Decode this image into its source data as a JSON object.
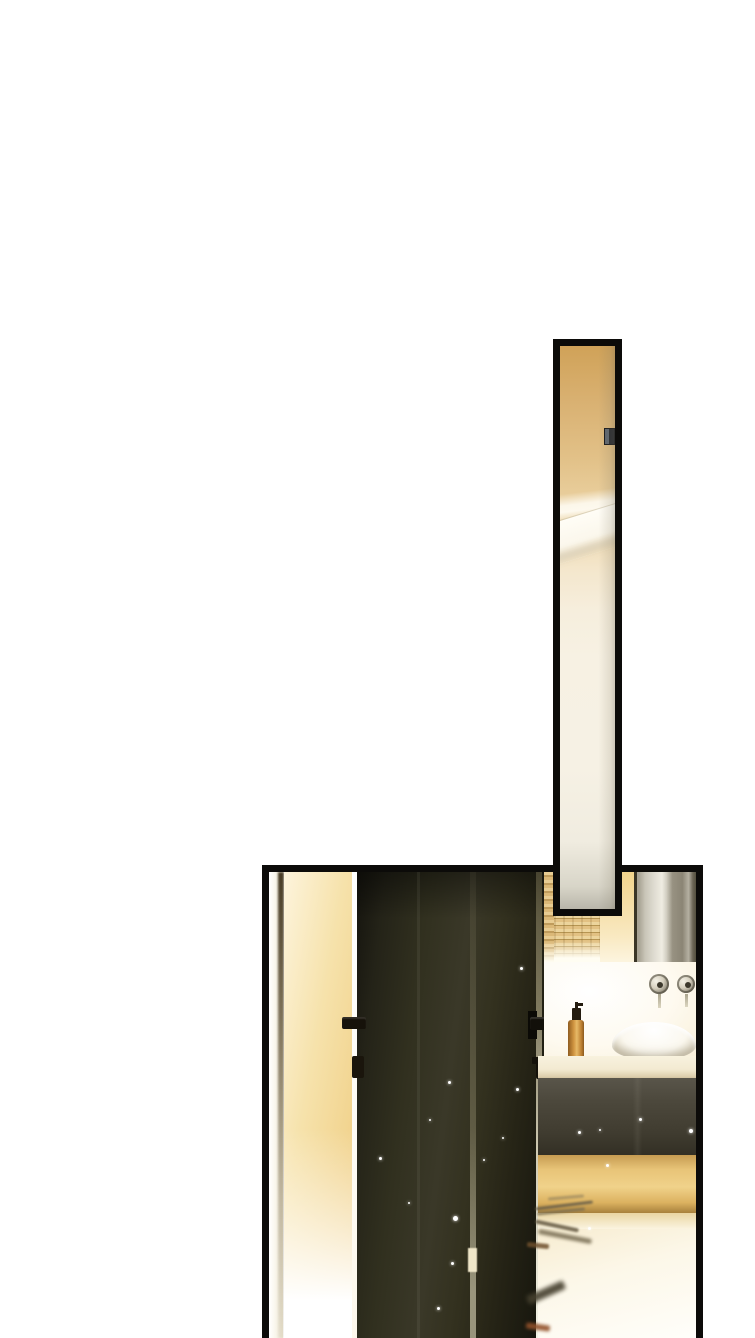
{
  "canvas": {
    "width": 755,
    "height": 1338,
    "background": "#ffffff"
  },
  "artwork": {
    "type": "webtoon-comic-page-fragment",
    "text_content": "none",
    "panel_count": 2,
    "panels": [
      {
        "name": "tall-mirror-panel",
        "x": 553,
        "y": 339,
        "width": 69,
        "height": 577,
        "border_color": "#0c0b09",
        "description": "narrow vertical panel: wall mirror reflecting a warm tan wall, a small dark handle, and a white diagonal room corner",
        "palette": {
          "top": "#d0a258",
          "middle": "#f6eedd",
          "bottom": "#b9b6aa",
          "handle": "#23262c"
        }
      },
      {
        "name": "bathroom-panel",
        "x": 262,
        "y": 865,
        "width": 441,
        "height": 473,
        "border_color": "#0c0b09",
        "clipped_at_page_bottom": true,
        "description": "dark open door revealing a warm-lit bathroom vanity: wicker baskets, wall mirror, two round wall taps, amber soap bottle, white vessel sink on cream counter, dark cabinet with golden drawer band and glowing floor with streak reflections",
        "palette": {
          "door": "#2b2a1c",
          "door_edge_light": "#fdf6dc",
          "gold_wall": "#eec878",
          "basket": "#dbb877",
          "mirror_glass": "#c9c5b8",
          "mirror_frame": "#3a3526",
          "counter": "#f3ead2",
          "cabinet": "#4c483c",
          "drawers_gold": "#e8c478",
          "floor": "#fcf7e8",
          "sink": "#fbf8ef",
          "bottle_amber": "#cf9440",
          "streaks": "#6b6049",
          "rust_streak": "#92512a"
        }
      }
    ],
    "sparkles": [
      {
        "x": 179,
        "y": 209,
        "s": 3
      },
      {
        "x": 160,
        "y": 247,
        "s": 2
      },
      {
        "x": 110,
        "y": 285,
        "s": 3
      },
      {
        "x": 139,
        "y": 330,
        "s": 2
      },
      {
        "x": 184,
        "y": 344,
        "s": 5
      },
      {
        "x": 182,
        "y": 390,
        "s": 3
      },
      {
        "x": 168,
        "y": 435,
        "s": 3
      },
      {
        "x": 247,
        "y": 216,
        "s": 3
      },
      {
        "x": 233,
        "y": 265,
        "s": 2
      },
      {
        "x": 251,
        "y": 95,
        "s": 3
      },
      {
        "x": 214,
        "y": 287,
        "s": 2
      },
      {
        "x": 309,
        "y": 259,
        "s": 3
      },
      {
        "x": 330,
        "y": 257,
        "s": 2
      },
      {
        "x": 370,
        "y": 246,
        "s": 3
      },
      {
        "x": 420,
        "y": 257,
        "s": 4
      },
      {
        "x": 337,
        "y": 292,
        "s": 3
      },
      {
        "x": 319,
        "y": 355,
        "s": 3
      }
    ],
    "floor_streaks": [
      {
        "x": 279,
        "y": 324,
        "w": 36,
        "h": 3,
        "rot": -5,
        "color": "#8a7c5c",
        "blur": 1,
        "opacity": 0.6
      },
      {
        "x": 266,
        "y": 332,
        "w": 58,
        "h": 3,
        "rot": -7,
        "color": "#6b6049",
        "blur": 1,
        "opacity": 0.9
      },
      {
        "x": 268,
        "y": 338,
        "w": 48,
        "h": 3,
        "rot": -6,
        "color": "#7a6e52",
        "blur": 1,
        "opacity": 0.8
      },
      {
        "x": 266,
        "y": 352,
        "w": 44,
        "h": 4,
        "rot": 12,
        "color": "#6b6049",
        "blur": 1,
        "opacity": 0.9
      },
      {
        "x": 269,
        "y": 362,
        "w": 54,
        "h": 5,
        "rot": 11,
        "color": "#756a50",
        "blur": 1.5,
        "opacity": 0.85
      },
      {
        "x": 258,
        "y": 371,
        "w": 22,
        "h": 5,
        "rot": 6,
        "color": "#6e4f2c",
        "blur": 1,
        "opacity": 0.85
      },
      {
        "x": 257,
        "y": 416,
        "w": 40,
        "h": 9,
        "rot": -24,
        "color": "#46402f",
        "blur": 2,
        "opacity": 0.9
      },
      {
        "x": 257,
        "y": 452,
        "w": 24,
        "h": 6,
        "rot": 8,
        "color": "#92512a",
        "blur": 1.5,
        "opacity": 0.9
      }
    ]
  }
}
